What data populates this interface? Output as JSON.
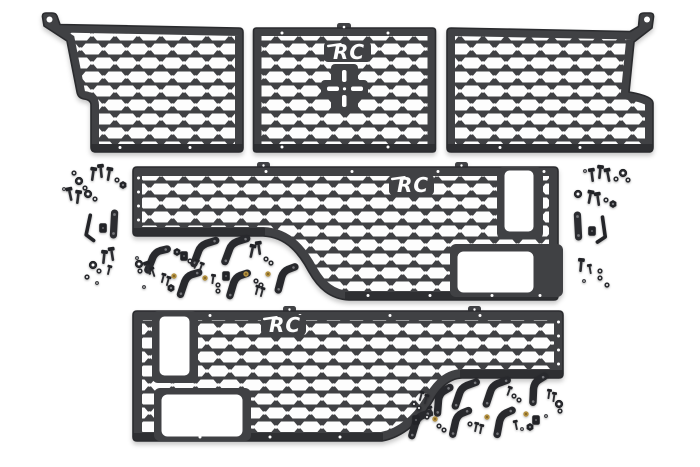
{
  "page": {
    "background_color": "#ffffff"
  },
  "product": {
    "brand_logo_text": "RC",
    "colors": {
      "panel": "#404144",
      "panel_edge": "#2a2b2e",
      "hardware": "#26272b",
      "brass_spacer": "#b3903f",
      "background": "#ffffff"
    },
    "panels": [
      {
        "id": "front-bed-panel-left",
        "mesh": "hex-molle-grid",
        "has_logo": false,
        "mount_tab_hole": true
      },
      {
        "id": "front-bed-panel-center",
        "mesh": "hex-molle-grid",
        "has_logo": true,
        "mount_tab_hole": false
      },
      {
        "id": "front-bed-panel-right",
        "mesh": "hex-molle-grid",
        "has_logo": false,
        "mount_tab_hole": true
      },
      {
        "id": "side-bed-panel-driver",
        "mesh": "hex-molle-grid",
        "has_logo": true,
        "cutouts": 2
      },
      {
        "id": "side-bed-panel-passenger",
        "mesh": "hex-molle-grid",
        "has_logo": true,
        "cutouts": 2
      }
    ],
    "hardware_items": [
      "hex-bolt",
      "flat-washer",
      "hex-nut",
      "bent-mounting-bracket",
      "strap-bracket",
      "flat-bar-bracket",
      "allen-key",
      "spacer-block",
      "brass-washer"
    ]
  }
}
